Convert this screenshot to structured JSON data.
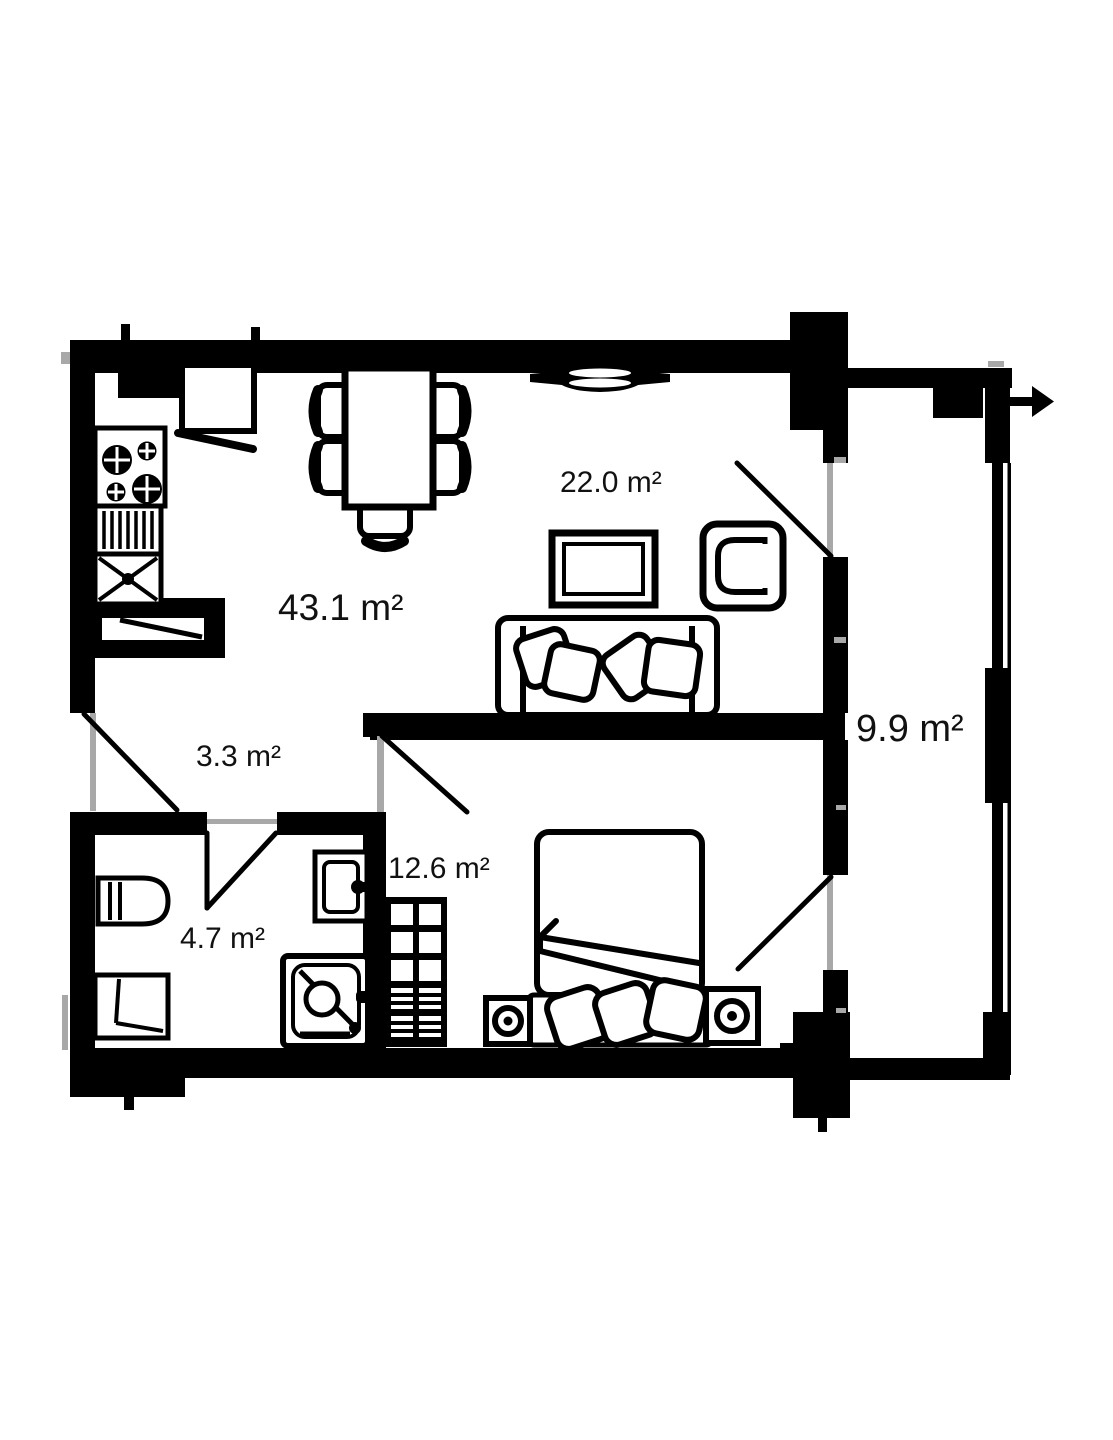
{
  "page": {
    "background": "#ffffff",
    "wall_color": "#000000",
    "frame_color": "#a8a8a8",
    "label_color": "#111111"
  },
  "rooms": [
    {
      "name": "kitchen-living-room",
      "area_label": "43.1 m²"
    },
    {
      "name": "living-area",
      "area_label": "22.0 m²"
    },
    {
      "name": "hallway",
      "area_label": "3.3 m²"
    },
    {
      "name": "bathroom",
      "area_label": "4.7 m²"
    },
    {
      "name": "bedroom",
      "area_label": "12.6 m²"
    },
    {
      "name": "balcony",
      "area_label": "9.9 m²"
    }
  ],
  "icons": [
    "stove-icon",
    "drainboard-icon",
    "kitchen-sink-icon",
    "fridge-icon",
    "kitchen-cabinet-icon",
    "dining-table-icon",
    "chair-icon",
    "vent-icon",
    "tv-icon",
    "armchair-icon",
    "sofa-icon",
    "pillow-icon",
    "bed-icon",
    "nightstand-icon",
    "wardrobe-icon",
    "washing-machine-icon",
    "toilet-icon",
    "washbasin-icon",
    "shower-icon",
    "door-swing-icon",
    "exit-arrow-icon"
  ]
}
